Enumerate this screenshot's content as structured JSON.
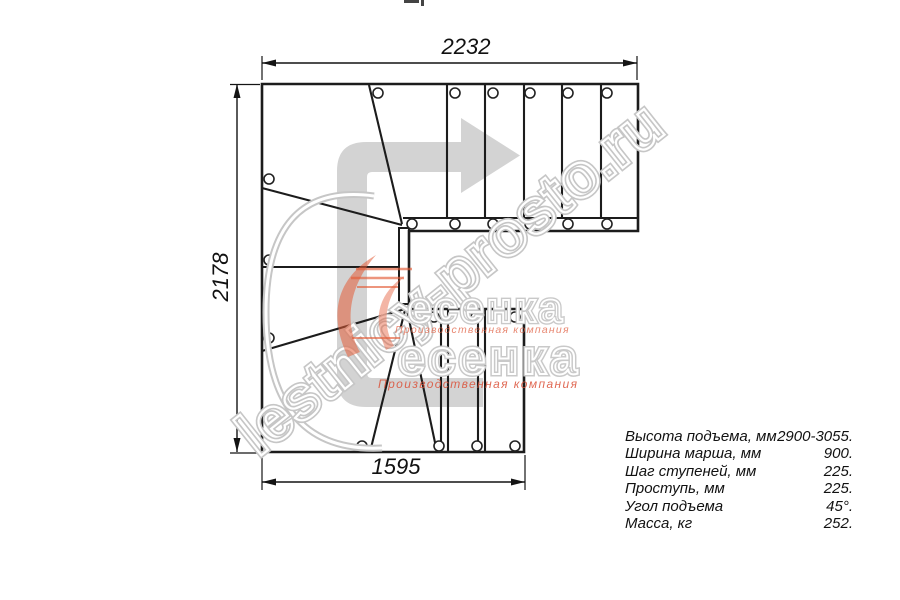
{
  "page": {
    "background": "#ffffff",
    "type": "staircase-plan-drawing"
  },
  "drawing": {
    "dimensions": {
      "top": "2232",
      "left": "2178",
      "bottom": "1595"
    },
    "direction_arrow": "u-turn-right"
  },
  "specs": {
    "rows": [
      {
        "label": "Высота подъема, мм",
        "value": "2900-3055."
      },
      {
        "label": "Ширина марша, мм",
        "value": "900."
      },
      {
        "label": "Шаг ступеней, мм",
        "value": "225."
      },
      {
        "label": "Проступь, мм",
        "value": "225."
      },
      {
        "label": "Угол подъема",
        "value": "45°."
      },
      {
        "label": "Масса, кг",
        "value": "252."
      }
    ]
  },
  "watermark": {
    "site": "lestnicy-prosto.ru",
    "logo_text": "есенка",
    "logo_subtitle": "Производственная компания"
  },
  "colors": {
    "line": "#1c1c1c",
    "arrow_gray": "#d3d3d3",
    "watermark_gray": "#c6c6c6",
    "accent_orange": "#e2674a"
  }
}
